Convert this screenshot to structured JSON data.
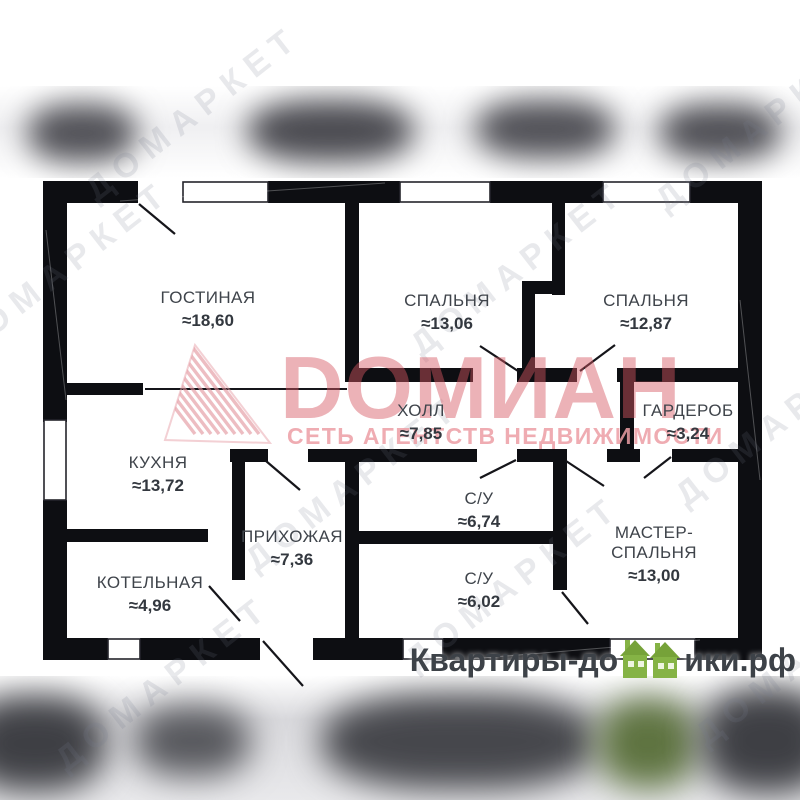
{
  "rooms": [
    {
      "id": "gostinaya",
      "name": "ГОСТИНАЯ",
      "area": "≈18,60"
    },
    {
      "id": "bedroom1",
      "name": "СПАЛЬНЯ",
      "area": "≈13,06"
    },
    {
      "id": "bedroom2",
      "name": "СПАЛЬНЯ",
      "area": "≈12,87"
    },
    {
      "id": "hall",
      "name": "ХОЛЛ",
      "area": "≈7,85"
    },
    {
      "id": "wardrobe",
      "name": "ГАРДЕРОБ",
      "area": "≈3,24"
    },
    {
      "id": "kitchen",
      "name": "КУХНЯ",
      "area": "≈13,72"
    },
    {
      "id": "bath1",
      "name": "С/У",
      "area": "≈6,74"
    },
    {
      "id": "entry",
      "name": "ПРИХОЖАЯ",
      "area": "≈7,36"
    },
    {
      "id": "master",
      "name": "МАСТЕР-СПАЛЬНЯ",
      "area": "≈13,00"
    },
    {
      "id": "boiler",
      "name": "КОТЕЛЬНАЯ",
      "area": "≈4,96"
    },
    {
      "id": "bath2",
      "name": "С/У",
      "area": "≈6,02"
    }
  ],
  "watermark_center": {
    "brand": "DОМИАН",
    "subtitle": "СЕТЬ АГЕНТСТВ НЕДВИЖИМОСТИ",
    "brand_color": "#d6585f",
    "subtitle_color": "#ec9ea5",
    "logo_icon": "pink-hatched-triangle-icon"
  },
  "diag_watermark": {
    "text": "ДОМАРКЕТ"
  },
  "site_logo": {
    "prefix": "Квартиры-до",
    "suffix": "ики.рф",
    "icon": "green-houses-icon",
    "green": "#85b345",
    "text_color": "#3d4248"
  },
  "plan_style": {
    "wall_color": "#0d0e12",
    "label_color": "#3f444b"
  }
}
